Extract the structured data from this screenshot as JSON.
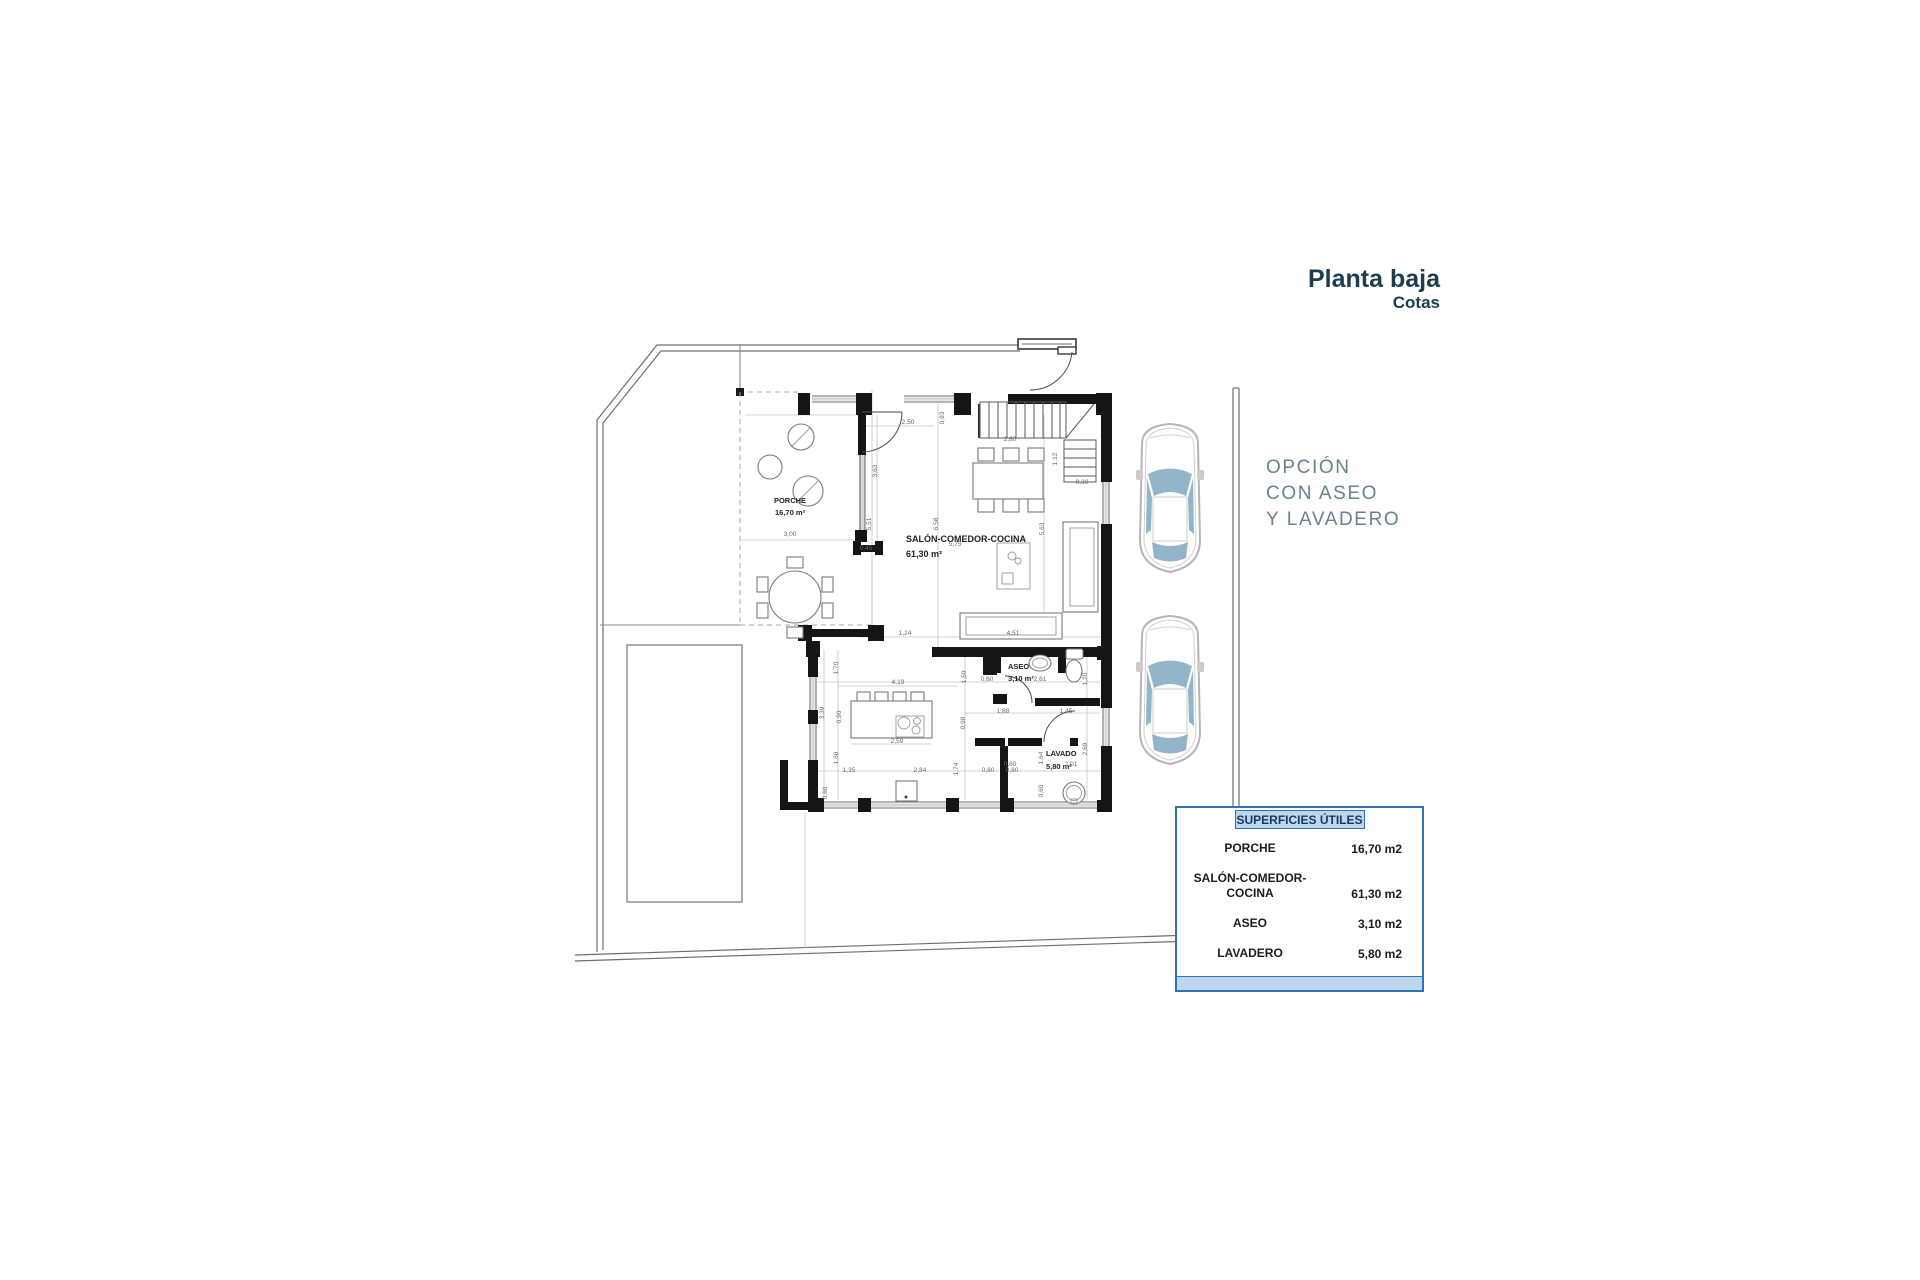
{
  "title": {
    "heading": "Planta baja",
    "subheading": "Cotas",
    "color": "#1d3c4e"
  },
  "option_note": {
    "lines": [
      "OPCIÓN",
      "CON ASEO",
      "Y LAVADERO"
    ],
    "color": "#68828f"
  },
  "surfaces_table": {
    "header": "SUPERFICIES ÚTILES",
    "border_color": "#2e74b5",
    "header_bg": "#bdd7ee",
    "rows": [
      {
        "label_lines": [
          "PORCHE"
        ],
        "value": "16,70 m2"
      },
      {
        "label_lines": [
          "SALÓN-COMEDOR-",
          "COCINA"
        ],
        "value": "61,30 m2"
      },
      {
        "label_lines": [
          "ASEO"
        ],
        "value": "3,10 m2"
      },
      {
        "label_lines": [
          "LAVADERO"
        ],
        "value": "5,80 m2"
      }
    ]
  },
  "floor_plan": {
    "room_labels": [
      {
        "text": "PORCHE",
        "x": 790,
        "y": 503,
        "anchor": "middle",
        "size": 7.5
      },
      {
        "text": "16,70 m²",
        "x": 790,
        "y": 515,
        "anchor": "middle",
        "size": 7.5
      },
      {
        "text": "SALÓN-COMEDOR-COCINA",
        "x": 906,
        "y": 542,
        "anchor": "start",
        "size": 9
      },
      {
        "text": "61,30 m²",
        "x": 906,
        "y": 557,
        "anchor": "start",
        "size": 9
      },
      {
        "text": "ASEO",
        "x": 1008,
        "y": 669,
        "anchor": "start",
        "size": 7.5
      },
      {
        "text": "3,10 m²",
        "x": 1008,
        "y": 681,
        "anchor": "start",
        "size": 7.5
      },
      {
        "text": "LAVADO",
        "x": 1046,
        "y": 756,
        "anchor": "start",
        "size": 7.5
      },
      {
        "text": "5,80 m²",
        "x": 1046,
        "y": 769,
        "anchor": "start",
        "size": 7.5
      }
    ],
    "dimensions": [
      {
        "x": 908,
        "y": 424,
        "rot": 0,
        "text": "2,50"
      },
      {
        "x": 944,
        "y": 418,
        "rot": 90,
        "text": "0,93"
      },
      {
        "x": 1010,
        "y": 441,
        "rot": 0,
        "text": "2,80"
      },
      {
        "x": 1057,
        "y": 459,
        "rot": 90,
        "text": "1,12"
      },
      {
        "x": 1082,
        "y": 484,
        "rot": 0,
        "text": "0,30"
      },
      {
        "x": 877,
        "y": 471,
        "rot": 90,
        "text": "3,63"
      },
      {
        "x": 871,
        "y": 524,
        "rot": 90,
        "text": "5,51"
      },
      {
        "x": 790,
        "y": 536,
        "rot": 0,
        "text": "3,00"
      },
      {
        "x": 938,
        "y": 524,
        "rot": 90,
        "text": "6,58"
      },
      {
        "x": 955,
        "y": 546,
        "rot": 0,
        "text": "5,75"
      },
      {
        "x": 1044,
        "y": 529,
        "rot": 90,
        "text": "5,63"
      },
      {
        "x": 866,
        "y": 550,
        "rot": 0,
        "text": "0,45"
      },
      {
        "x": 905,
        "y": 635,
        "rot": 0,
        "text": "1,24"
      },
      {
        "x": 1013,
        "y": 635,
        "rot": 0,
        "text": "4,51"
      },
      {
        "x": 838,
        "y": 668,
        "rot": 90,
        "text": "1,70"
      },
      {
        "x": 966,
        "y": 677,
        "rot": 90,
        "text": "1,50"
      },
      {
        "x": 987,
        "y": 681,
        "rot": 0,
        "text": "0,60"
      },
      {
        "x": 1040,
        "y": 681,
        "rot": 0,
        "text": "2,61"
      },
      {
        "x": 1087,
        "y": 679,
        "rot": 90,
        "text": "1,20"
      },
      {
        "x": 898,
        "y": 684,
        "rot": 0,
        "text": "4,19"
      },
      {
        "x": 824,
        "y": 713,
        "rot": 90,
        "text": "3,39"
      },
      {
        "x": 841,
        "y": 717,
        "rot": 90,
        "text": "0,90"
      },
      {
        "x": 965,
        "y": 723,
        "rot": 90,
        "text": "0,98"
      },
      {
        "x": 1003,
        "y": 713,
        "rot": 0,
        "text": "1,88"
      },
      {
        "x": 1066,
        "y": 713,
        "rot": 0,
        "text": "1,45"
      },
      {
        "x": 897,
        "y": 743,
        "rot": 0,
        "text": "2,59"
      },
      {
        "x": 838,
        "y": 758,
        "rot": 90,
        "text": "1,60"
      },
      {
        "x": 1043,
        "y": 758,
        "rot": 90,
        "text": "1,64"
      },
      {
        "x": 1087,
        "y": 749,
        "rot": 90,
        "text": "2,69"
      },
      {
        "x": 1071,
        "y": 766,
        "rot": 0,
        "text": "2,01"
      },
      {
        "x": 1010,
        "y": 766,
        "rot": 0,
        "text": "0,60"
      },
      {
        "x": 849,
        "y": 772,
        "rot": 0,
        "text": "1,35"
      },
      {
        "x": 920,
        "y": 772,
        "rot": 0,
        "text": "2,84"
      },
      {
        "x": 958,
        "y": 769,
        "rot": 90,
        "text": "1,74"
      },
      {
        "x": 988,
        "y": 772,
        "rot": 0,
        "text": "0,80"
      },
      {
        "x": 1012,
        "y": 772,
        "rot": 0,
        "text": "0,80"
      },
      {
        "x": 827,
        "y": 793,
        "rot": 90,
        "text": "0,60"
      },
      {
        "x": 1043,
        "y": 791,
        "rot": 90,
        "text": "0,60"
      }
    ]
  }
}
